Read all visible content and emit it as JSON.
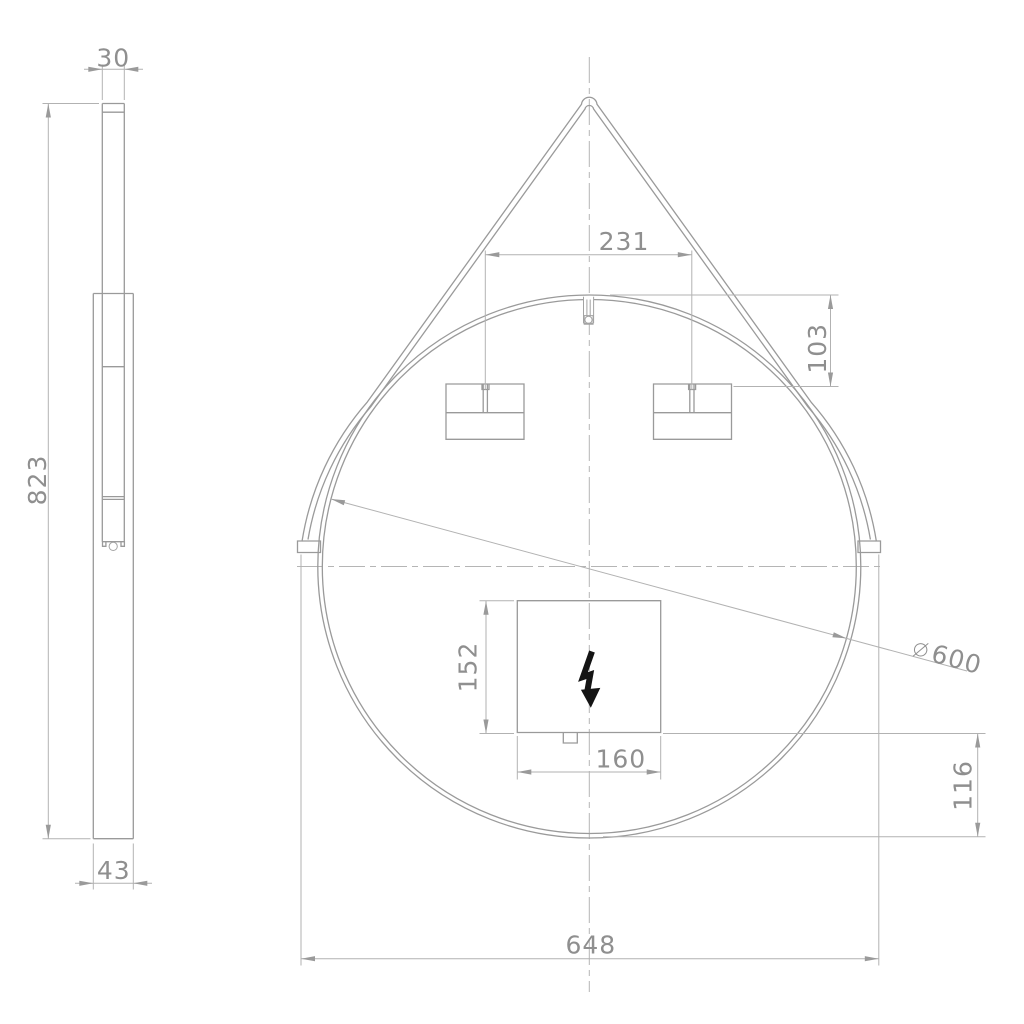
{
  "drawing": {
    "kind": "technical-dimension-drawing",
    "subject": "round-hanging-mirror-with-strap",
    "colors": {
      "background": "#ffffff",
      "object_line": "#9a9a9a",
      "dimension_line": "#b2b2b2",
      "dimension_text": "#8f8f8f",
      "bolt_symbol": "#141414"
    },
    "side_view": {
      "dims": {
        "top_thickness": "30",
        "height": "823",
        "bottom_depth": "43"
      }
    },
    "front_view": {
      "dims": {
        "bracket_spacing": "231",
        "bracket_vertical_offset": "103",
        "diameter_symbol": "⌀",
        "diameter_value": "600",
        "junction_box_height": "152",
        "junction_box_width": "160",
        "bottom_offset": "116",
        "overall_width": "648"
      },
      "symbols": {
        "lightning_bolt": "electrical-connection"
      }
    }
  }
}
